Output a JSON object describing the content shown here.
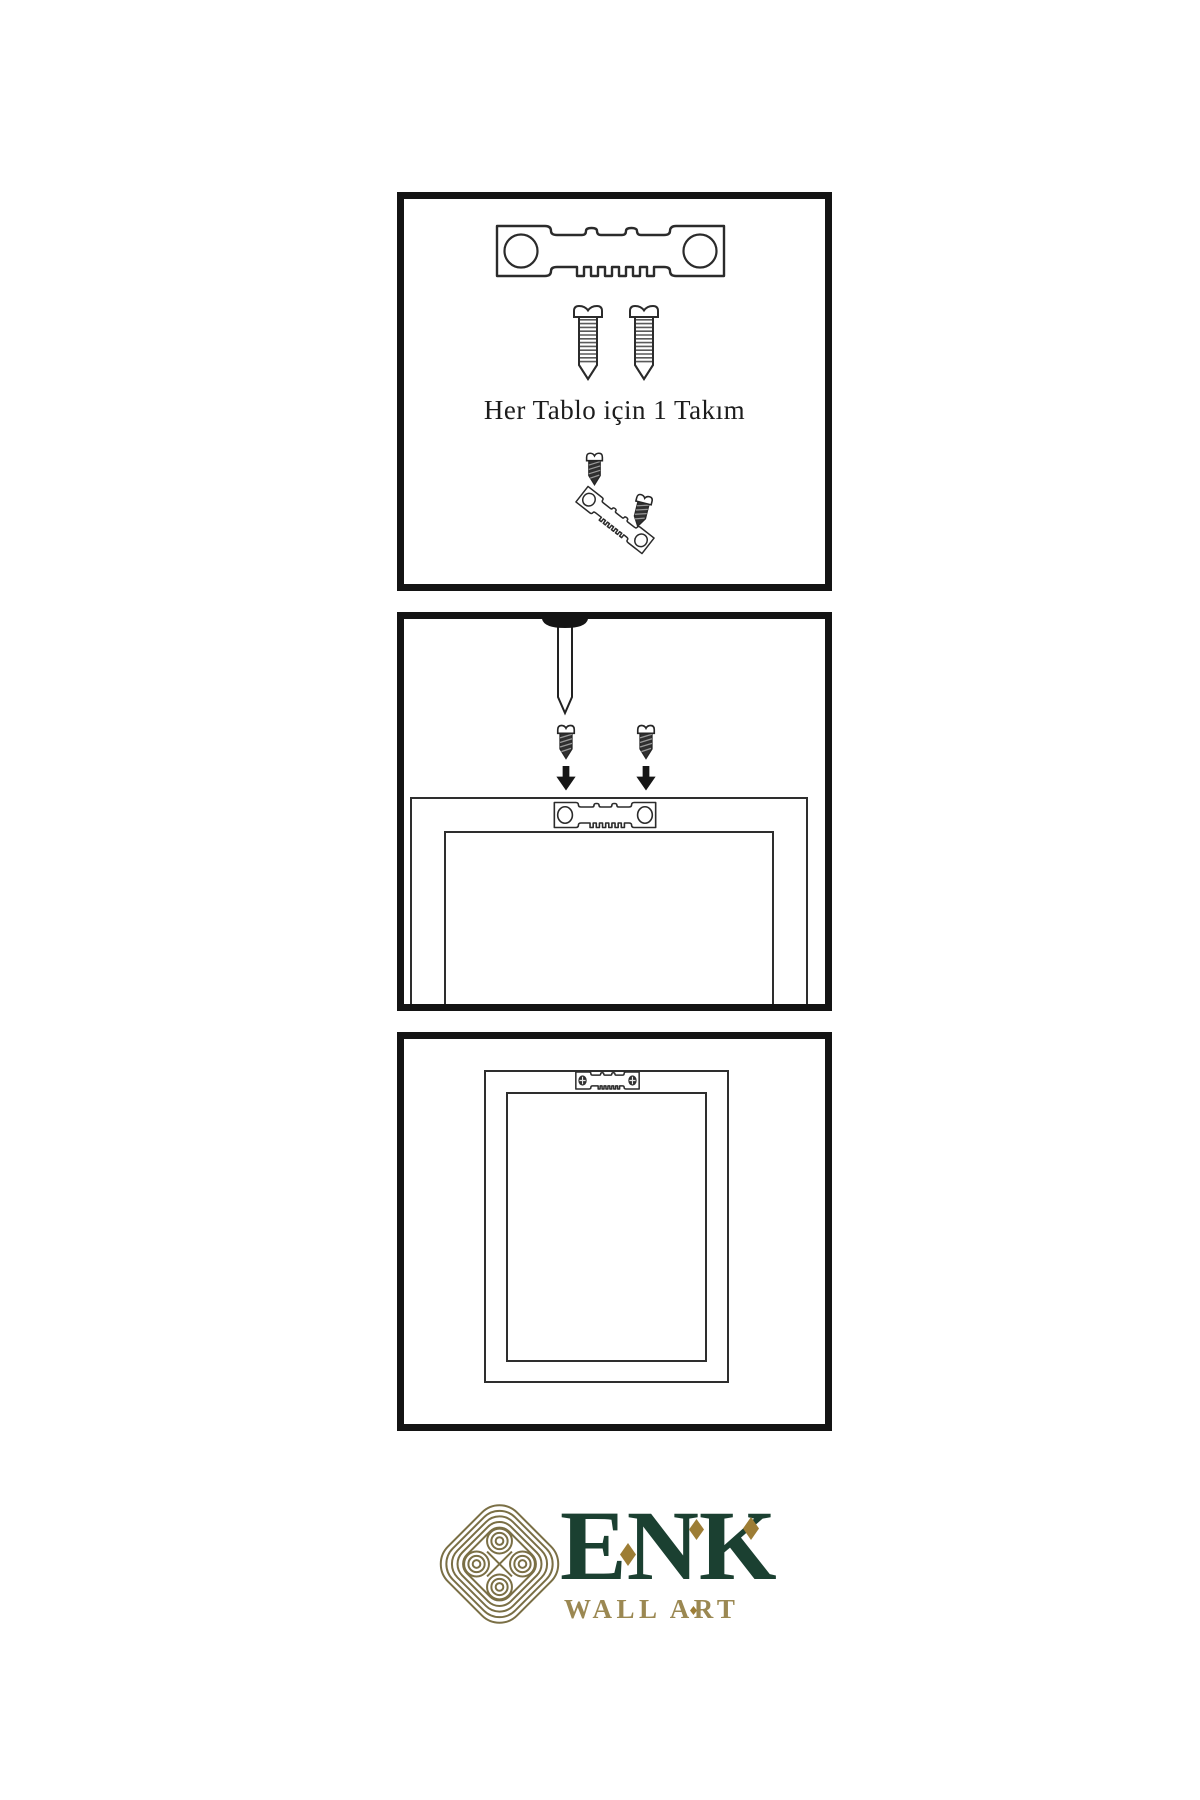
{
  "document_type": "wall-art hanging instruction sheet",
  "colors": {
    "background": "#ffffff",
    "panel_border": "#141414",
    "ink": "#1c1c1c",
    "line": "#2e2e2e",
    "logo_green": "#1b4031",
    "logo_gold": "#9d7d35",
    "logo_gold_light": "#9b8852",
    "logo_knot": "#7a6f45"
  },
  "panels": [
    {
      "name": "hardware-kit",
      "caption": "Her Tablo için 1 Takım",
      "icons": [
        "sawtooth-hanger",
        "screw",
        "screw",
        "screw-into-tilted-hanger"
      ]
    },
    {
      "name": "wall-mounting",
      "icons": [
        "nail-in-wall",
        "screw",
        "screw",
        "arrow-down",
        "arrow-down",
        "sawtooth-hanger-on-frame-back"
      ]
    },
    {
      "name": "hung-frame",
      "icons": [
        "frame-back",
        "sawtooth-hanger-with-phillips-screws"
      ]
    }
  ],
  "logo": {
    "brand": "ENK",
    "subtitle": "WALL ART",
    "emblem": "celtic-knot",
    "accents": [
      "diamond",
      "diamond",
      "diamond",
      "small-diamond"
    ]
  }
}
